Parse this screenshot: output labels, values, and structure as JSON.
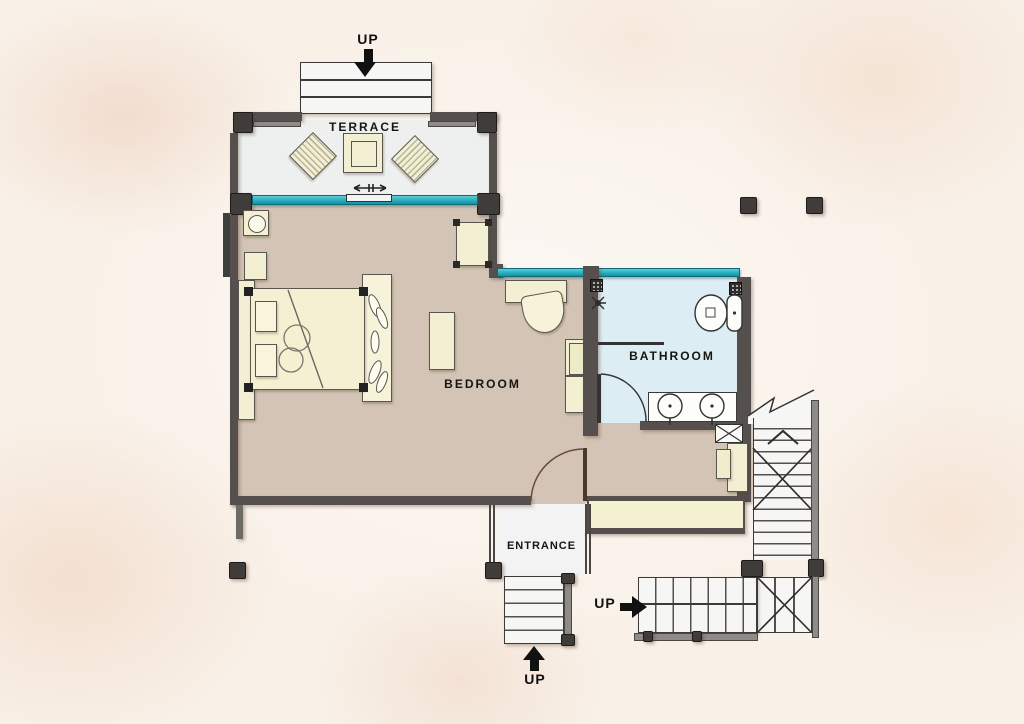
{
  "plan": {
    "rooms": {
      "terrace": {
        "label": "TERRACE",
        "floor_color": "#edf0ef"
      },
      "bedroom": {
        "label": "BEDROOM",
        "floor_color": "#d3c4b5"
      },
      "bathroom": {
        "label": "BATHROOM",
        "floor_color": "#ddedf4"
      },
      "entrance": {
        "label": "ENTRANCE",
        "floor_color": "#f3f3f3"
      }
    },
    "stairs": {
      "terrace_stairs_label": "UP",
      "entrance_stairs_label": "UP",
      "side_stairs_label": "UP"
    },
    "fixtures": [
      "bed",
      "pillows",
      "lounge-chair",
      "lounge-chair",
      "terrace-table",
      "desk",
      "desk-chair",
      "armchair",
      "bench",
      "wardrobe",
      "closet",
      "nightstand",
      "nightstand",
      "toilet",
      "double-sink-vanity",
      "shower-head",
      "sliding-door",
      "duct-shaft",
      "cabinet",
      "entry-bench"
    ],
    "colors": {
      "wall": "#55504d",
      "column": "#3f3c3a",
      "window_glass": "#2fb4c5",
      "furniture": "#f2efd2",
      "bedroom_floor": "#d3c4b5",
      "bathroom_floor": "#ddedf4",
      "terrace_floor": "#edf0ef",
      "background": "#f9f1e8"
    }
  }
}
